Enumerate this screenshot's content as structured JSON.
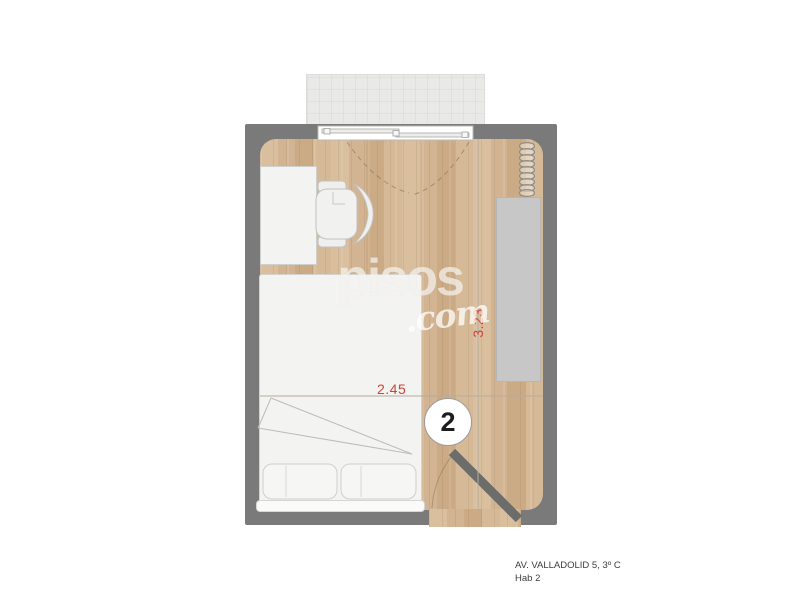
{
  "floorplan": {
    "room_number": "2",
    "dimensions": {
      "width_label": "2.45",
      "height_label": "3.23"
    },
    "fixtures": [
      "balcony-area",
      "sliding-window",
      "radiator",
      "wardrobe",
      "desk",
      "office-chair",
      "bed",
      "pillow",
      "pillow",
      "door"
    ],
    "colors": {
      "wall_gray": "#7a7a7a",
      "wood_light": "#d9bf9e",
      "wood_dark": "#cbab85",
      "balcony_gray": "#e9e9e8",
      "wardrobe_gray": "#c7c7c7",
      "furniture_fill": "#f3f3f1",
      "accent_red": "#c9453a"
    }
  },
  "watermark": {
    "brand": "pisos",
    "suffix": ".com"
  },
  "caption": {
    "line1": "AV. VALLADOLID 5, 3º C",
    "line2": "Hab 2"
  }
}
